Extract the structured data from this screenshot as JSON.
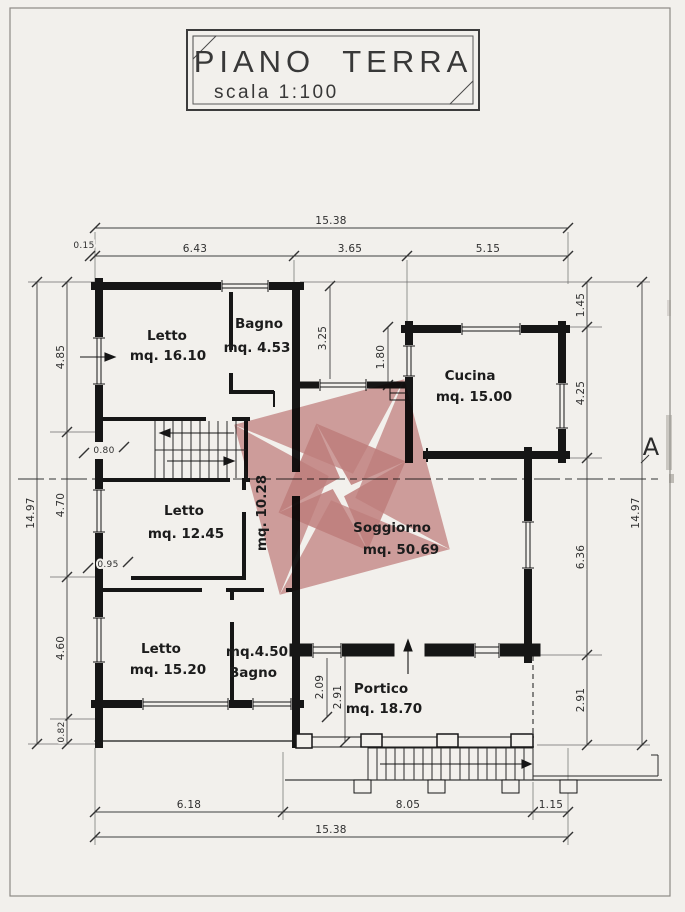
{
  "title_block": {
    "title": "PIANO TERRA",
    "scale_label": "scala 1:100"
  },
  "rooms": {
    "letto1": {
      "name": "Letto",
      "area": "mq. 16.10"
    },
    "bagno1": {
      "name": "Bagno",
      "area": "mq. 4.53"
    },
    "cucina": {
      "name": "Cucina",
      "area": "mq. 15.00"
    },
    "letto2": {
      "name": "Letto",
      "area": "mq. 12.45"
    },
    "disimpegno": {
      "area": "mq. 10.28"
    },
    "soggiorno": {
      "name": "Soggiorno",
      "area": "mq. 50.69"
    },
    "letto3": {
      "name": "Letto",
      "area": "mq. 15.20"
    },
    "bagno2": {
      "name": "Bagno",
      "area": "mq.4.50"
    },
    "portico": {
      "name": "Portico",
      "area": "mq. 18.70"
    }
  },
  "dims": {
    "top_overall": "15.38",
    "top_offset": "0.15",
    "top_seg1": "6.43",
    "top_seg2": "3.65",
    "top_seg3": "5.15",
    "left_overall": "14.97",
    "left_seg1": "4.85",
    "left_seg2": "4.70",
    "left_seg3": "4.60",
    "left_seg4": "0.82",
    "right_seg1": "1.45",
    "right_seg2": "4.25",
    "right_seg3": "6.36",
    "right_seg4": "2.91",
    "right_overall": "14.97",
    "bottom_seg1": "6.18",
    "bottom_seg2": "8.05",
    "bottom_seg3": "1.15",
    "bottom_overall": "15.38",
    "door1": "0.80",
    "door2": "0.95",
    "court1": "3.25",
    "court2": "1.80",
    "portico_depth1": "2.09",
    "portico_depth2": "2.91"
  },
  "section": {
    "label": "A"
  },
  "colors": {
    "watermark_light": "#d49c9c",
    "watermark_dark": "#c47878",
    "ink": "#161616"
  }
}
